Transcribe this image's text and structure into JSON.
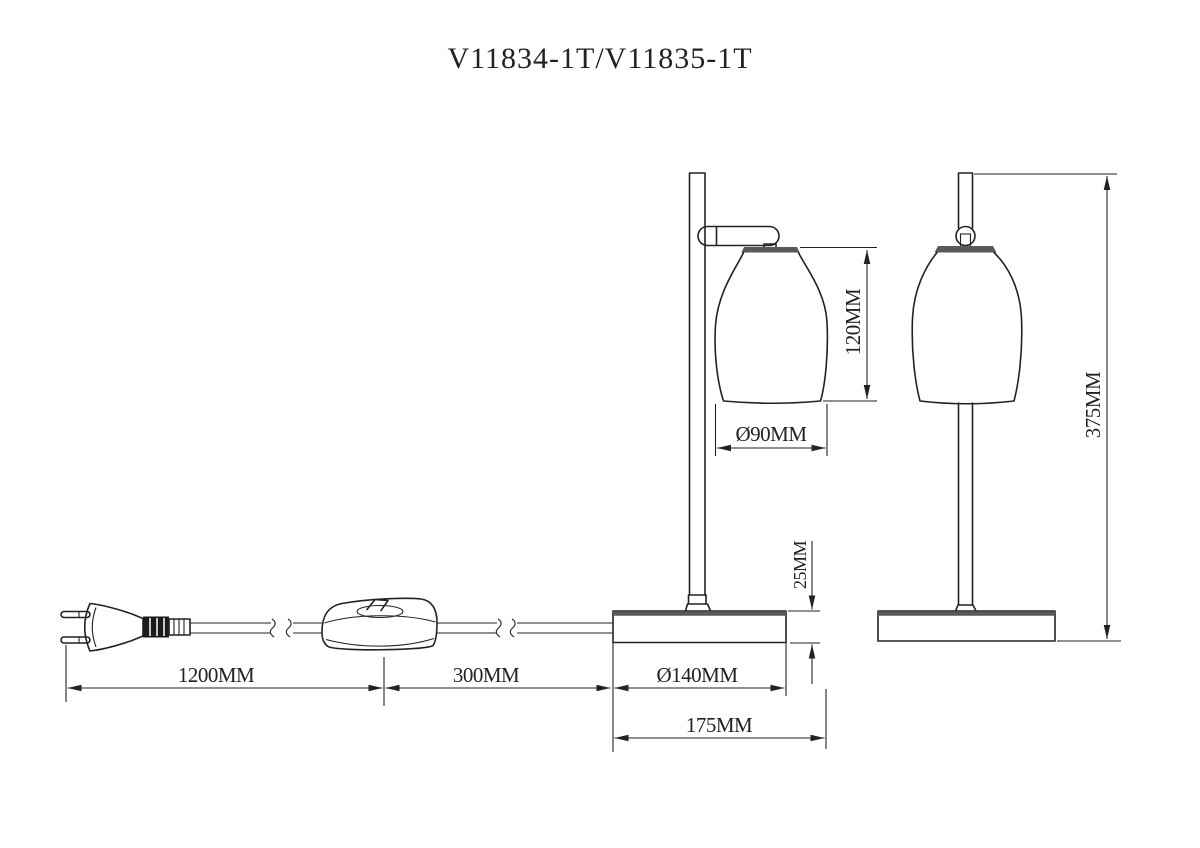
{
  "title": "V11834-1T/V11835-1T",
  "dimensions": {
    "shade_height": "120MM",
    "shade_diameter": "Ø90MM",
    "base_height": "25MM",
    "total_height": "375MM",
    "cord_length": "1200MM",
    "switch_to_base": "300MM",
    "base_diameter": "Ø140MM",
    "base_overall": "175MM"
  },
  "colors": {
    "line": "#222222",
    "thick_bar": "#58595b",
    "background": "#ffffff"
  }
}
